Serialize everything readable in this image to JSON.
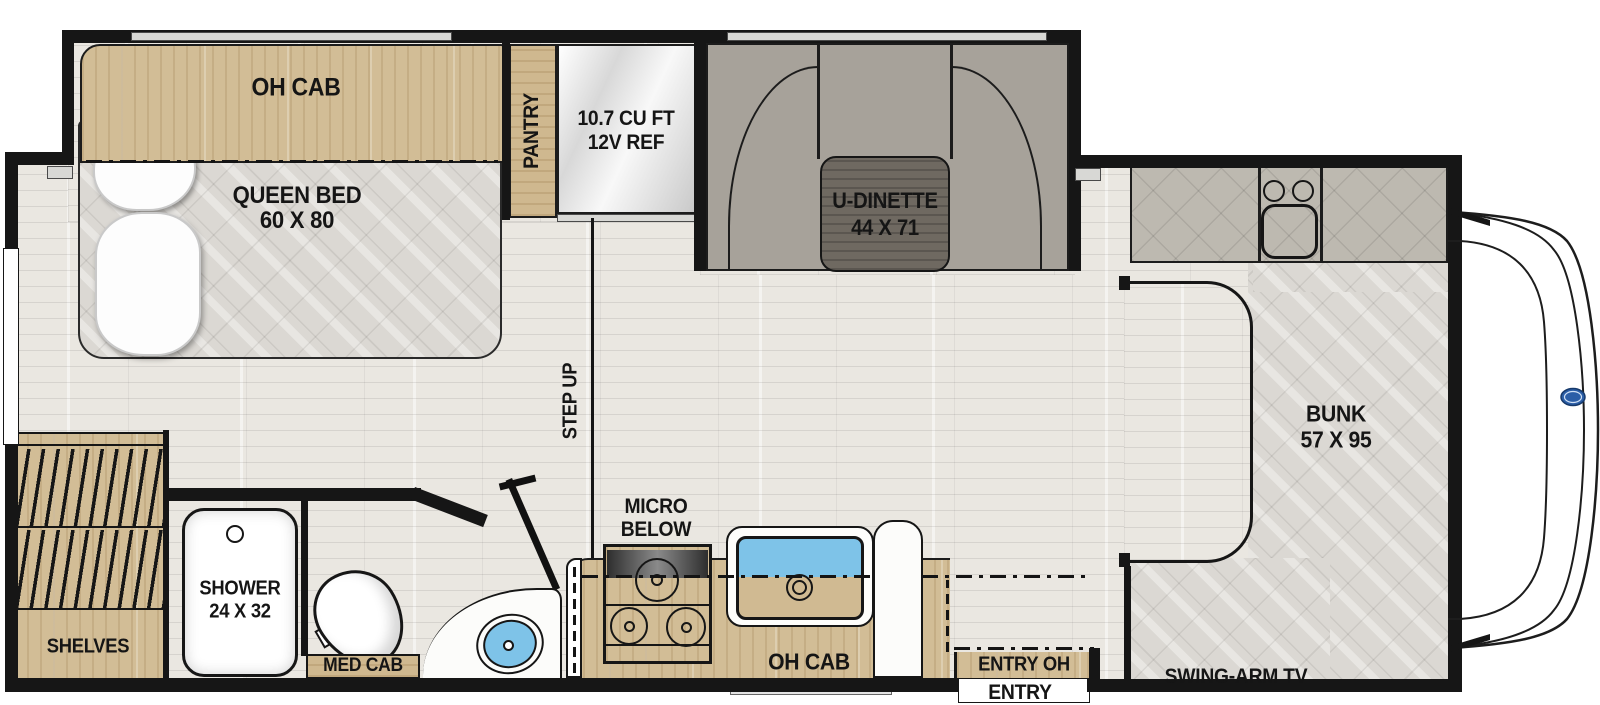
{
  "title": "RV / motorhome floor plan",
  "colors": {
    "wall": "#161616",
    "wood_cabinet": "#d2bd96",
    "dark_table": "#6f6961",
    "bench_gray": "#a7a29a",
    "mattress_quilt": "#dbd8d3",
    "counter_quilt": "#bdb9b0",
    "sink_water": "#7ec3e8",
    "floor": "#eae7e1",
    "ford_badge_blue": "#2b5ea7"
  },
  "rooms": {
    "bedroom": {
      "oh_cab": "OH CAB",
      "bed_line1": "QUEEN BED",
      "bed_line2": "60 X 80"
    },
    "galley": {
      "pantry": "PANTRY",
      "fridge_line1": "10.7 CU FT",
      "fridge_line2": "12V REF",
      "micro_line1": "MICRO",
      "micro_line2": "BELOW",
      "oh_cab": "OH CAB",
      "step_up": "STEP UP"
    },
    "dinette": {
      "line1": "U-DINETTE",
      "line2": "44 X 71"
    },
    "bath": {
      "shower_line1": "SHOWER",
      "shower_line2": "24 X 32",
      "med_cab": "MED CAB",
      "shelves": "SHELVES"
    },
    "front": {
      "bunk_line1": "BUNK",
      "bunk_line2": "57 X 95",
      "swing_arm_tv": "SWING-ARM TV",
      "entry_oh": "ENTRY OH",
      "entry": "ENTRY"
    }
  }
}
